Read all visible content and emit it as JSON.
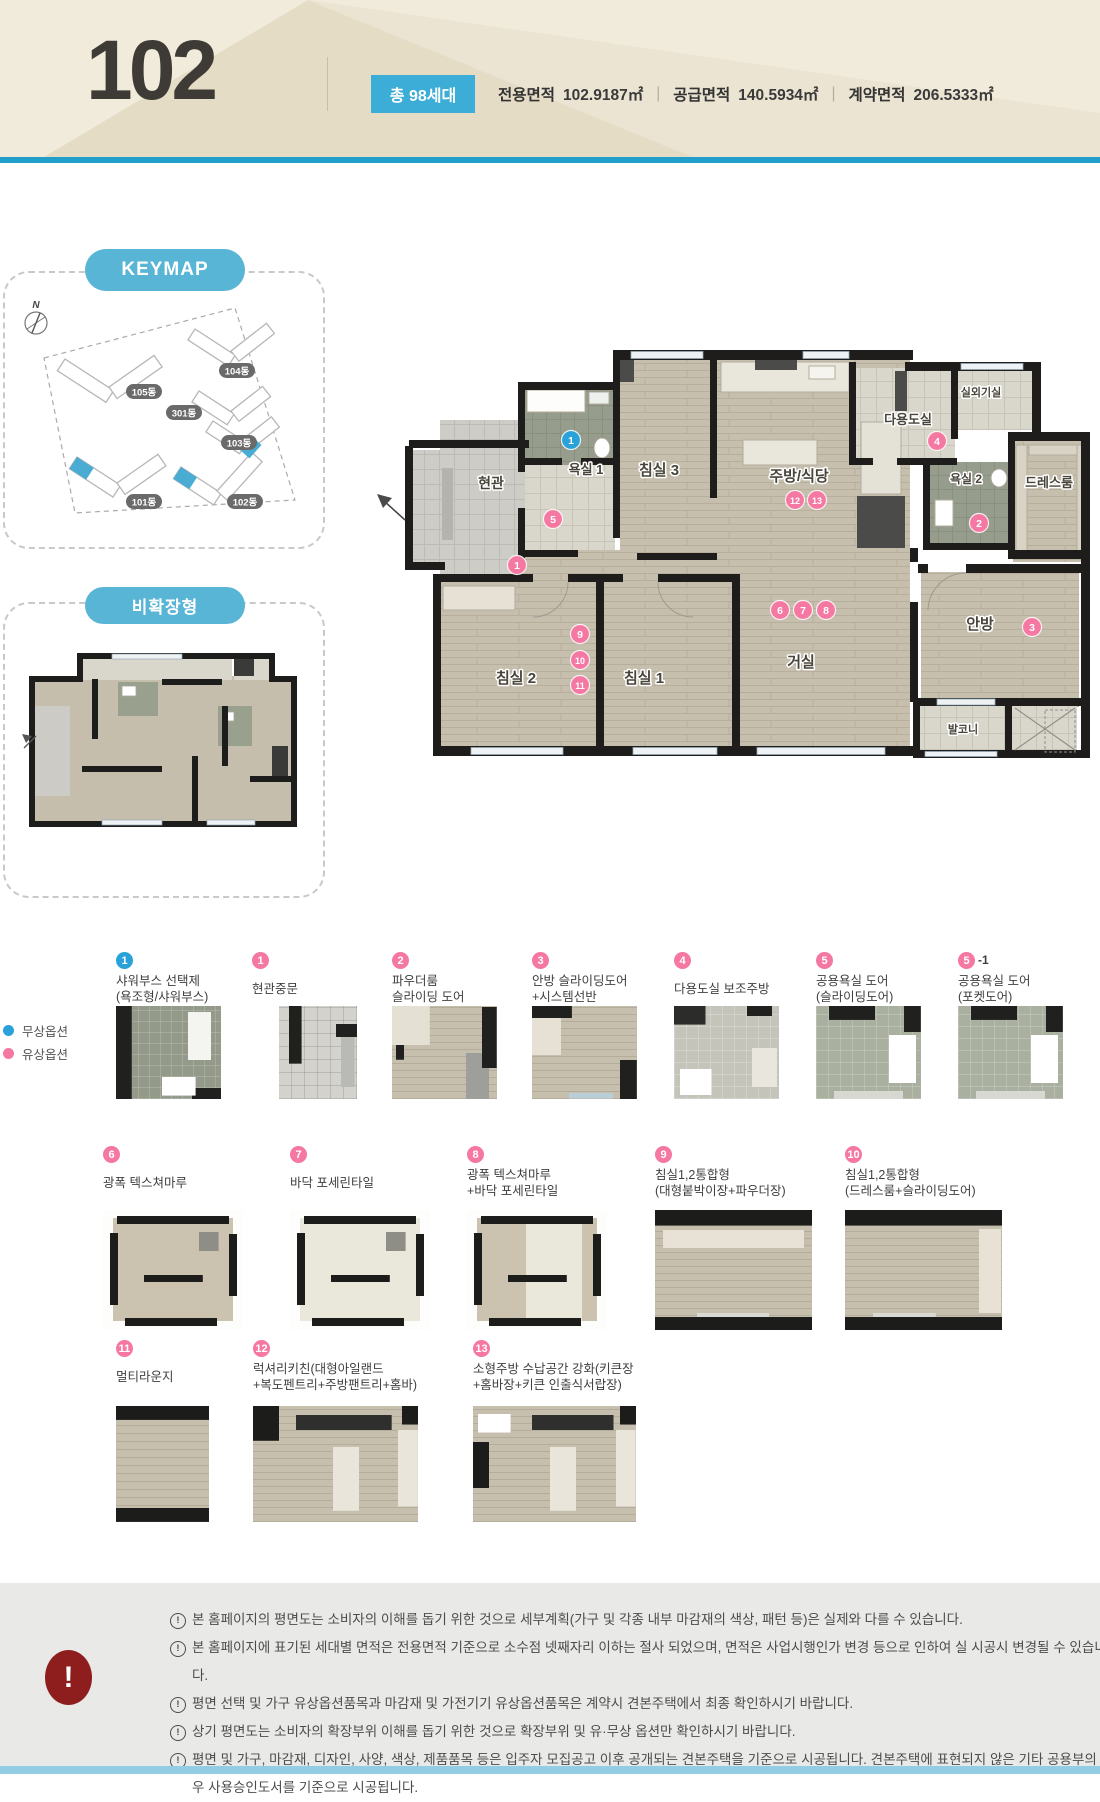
{
  "header": {
    "unit": "102",
    "badge": "총 98세대",
    "areas": [
      {
        "label": "전용면적",
        "value": "102.9187㎡"
      },
      {
        "label": "공급면적",
        "value": "140.5934㎡"
      },
      {
        "label": "계약면적",
        "value": "206.5333㎡"
      }
    ]
  },
  "keymap": {
    "title": "KEYMAP",
    "compass": "N",
    "buildings": [
      {
        "name": "105동",
        "x": 141,
        "y": 121
      },
      {
        "name": "104동",
        "x": 234,
        "y": 100
      },
      {
        "name": "301동",
        "x": 181,
        "y": 142
      },
      {
        "name": "103동",
        "x": 236,
        "y": 172
      },
      {
        "name": "101동",
        "x": 141,
        "y": 231
      },
      {
        "name": "102동",
        "x": 242,
        "y": 231
      }
    ]
  },
  "nonexpanded_title": "비확장형",
  "floorplan": {
    "rooms": [
      {
        "name": "현관",
        "x": 126,
        "y": 138,
        "s": 14
      },
      {
        "name": "욕실 1",
        "x": 221,
        "y": 124,
        "s": 13
      },
      {
        "name": "침실 3",
        "x": 294,
        "y": 125,
        "s": 15
      },
      {
        "name": "주방/식당",
        "x": 434,
        "y": 131,
        "s": 15
      },
      {
        "name": "다용도실",
        "x": 543,
        "y": 74,
        "s": 13
      },
      {
        "name": "실외기실",
        "x": 616,
        "y": 46,
        "s": 11
      },
      {
        "name": "욕실 2",
        "x": 601,
        "y": 133,
        "s": 12
      },
      {
        "name": "드레스룸",
        "x": 684,
        "y": 137,
        "s": 13
      },
      {
        "name": "안방",
        "x": 615,
        "y": 279,
        "s": 15
      },
      {
        "name": "거실",
        "x": 436,
        "y": 317,
        "s": 15
      },
      {
        "name": "침실 1",
        "x": 279,
        "y": 333,
        "s": 15
      },
      {
        "name": "침실 2",
        "x": 151,
        "y": 333,
        "s": 15
      },
      {
        "name": "발코니",
        "x": 598,
        "y": 383,
        "s": 11
      }
    ],
    "markers": [
      {
        "n": "1",
        "c": "blue",
        "x": 206,
        "y": 90
      },
      {
        "n": "5",
        "c": "pink",
        "x": 188,
        "y": 169
      },
      {
        "n": "1",
        "c": "pink",
        "x": 152,
        "y": 215
      },
      {
        "n": "12",
        "c": "pink",
        "x": 430,
        "y": 150
      },
      {
        "n": "13",
        "c": "pink",
        "x": 452,
        "y": 150
      },
      {
        "n": "4",
        "c": "pink",
        "x": 572,
        "y": 91
      },
      {
        "n": "2",
        "c": "pink",
        "x": 614,
        "y": 173
      },
      {
        "n": "3",
        "c": "pink",
        "x": 667,
        "y": 277
      },
      {
        "n": "6",
        "c": "pink",
        "x": 415,
        "y": 260
      },
      {
        "n": "7",
        "c": "pink",
        "x": 438,
        "y": 260
      },
      {
        "n": "8",
        "c": "pink",
        "x": 461,
        "y": 260
      },
      {
        "n": "9",
        "c": "pink",
        "x": 215,
        "y": 284
      },
      {
        "n": "10",
        "c": "pink",
        "x": 215,
        "y": 310
      },
      {
        "n": "11",
        "c": "pink",
        "x": 215,
        "y": 335
      }
    ]
  },
  "legend": {
    "free": "무상옵션",
    "paid": "유상옵션"
  },
  "colors": {
    "blue": "#29a2d9",
    "pink": "#f478a1",
    "teal": "#58b5d6"
  },
  "options": [
    {
      "num": "1",
      "color": "blue",
      "lines": [
        "샤워부스 선택제",
        "(욕조형/샤워부스)"
      ],
      "thumb": "bath-a",
      "thumb_name": "shower-booth-option-thumbnail"
    },
    {
      "num": "1",
      "color": "pink",
      "lines": [
        "현관중문"
      ],
      "thumb": "entry",
      "thumb_name": "entry-middle-door-option-thumbnail"
    },
    {
      "num": "2",
      "color": "pink",
      "lines": [
        "파우더룸",
        "슬라이딩 도어"
      ],
      "thumb": "powder",
      "thumb_name": "powder-room-sliding-door-option-thumbnail"
    },
    {
      "num": "3",
      "color": "pink",
      "lines": [
        "안방 슬라이딩도어",
        "+시스템선반"
      ],
      "thumb": "room-a",
      "thumb_name": "master-sliding-door-option-thumbnail"
    },
    {
      "num": "4",
      "color": "pink",
      "lines": [
        "다용도실 보조주방"
      ],
      "thumb": "utility",
      "thumb_name": "utility-sub-kitchen-option-thumbnail"
    },
    {
      "num": "5",
      "color": "pink",
      "lines": [
        "공용욕실 도어",
        "(슬라이딩도어)"
      ],
      "thumb": "bath-b",
      "thumb_name": "shared-bath-sliding-door-option-thumbnail"
    },
    {
      "num": "5",
      "suffix": "-1",
      "color": "pink",
      "lines": [
        "공용욕실 도어",
        "(포켓도어)"
      ],
      "thumb": "bath-b",
      "thumb_name": "shared-bath-pocket-door-option-thumbnail"
    },
    {
      "num": "6",
      "color": "pink",
      "lines": [
        "광폭 텍스쳐마루"
      ],
      "thumb": "plan-wood",
      "thumb_name": "wide-textured-floor-option-thumbnail"
    },
    {
      "num": "7",
      "color": "pink",
      "lines": [
        "바닥 포세린타일"
      ],
      "thumb": "plan-tile",
      "thumb_name": "porcelain-tile-floor-option-thumbnail"
    },
    {
      "num": "8",
      "color": "pink",
      "lines": [
        "광폭 텍스쳐마루",
        "+바닥 포세린타일"
      ],
      "thumb": "plan-mix",
      "thumb_name": "mixed-floor-option-thumbnail"
    },
    {
      "num": "9",
      "color": "pink",
      "lines": [
        "침실1,2통합형",
        "(대형붙박이장+파우더장)"
      ],
      "thumb": "wide-a",
      "thumb_name": "combined-bedroom-closet-option-thumbnail"
    },
    {
      "num": "10",
      "color": "pink",
      "lines": [
        "침실1,2통합형",
        "(드레스룸+슬라이딩도어)"
      ],
      "thumb": "wide-b",
      "thumb_name": "combined-bedroom-dressroom-option-thumbnail"
    },
    {
      "num": "11",
      "color": "pink",
      "lines": [
        "멀티라운지"
      ],
      "thumb": "lounge",
      "thumb_name": "multi-lounge-option-thumbnail"
    },
    {
      "num": "12",
      "color": "pink",
      "lines": [
        "럭셔리키친(대형아일랜드",
        "+복도펜트리+주방팬트리+홈바)"
      ],
      "thumb": "kitchen-a",
      "thumb_name": "luxury-kitchen-option-thumbnail"
    },
    {
      "num": "13",
      "color": "pink",
      "lines": [
        "소형주방 수납공간 강화(키큰장",
        "+홈바장+키큰 인출식서랍장)"
      ],
      "thumb": "kitchen-b",
      "thumb_name": "small-kitchen-storage-option-thumbnail"
    }
  ],
  "notices": {
    "icon": "!",
    "items": [
      "본 홈페이지의 평면도는 소비자의 이해를 돕기 위한 것으로 세부계획(가구 및 각종 내부 마감재의 색상, 패턴 등)은 실제와 다를 수 있습니다.",
      "본 홈페이지에 표기된 세대별 면적은 전용면적 기준으로 소수점 넷째자리 이하는 절사 되었으며, 면적은 사업시행인가 변경 등으로 인하여 실 시공시 변경될 수 있습니다.",
      "평면 선택 및 가구 유상옵션품목과 마감재 및 가전기기 유상옵션품목은 계약시 견본주택에서 최종 확인하시기 바랍니다.",
      "상기 평면도는 소비자의 확장부위 이해를 돕기 위한 것으로 확장부위 및 유·무상 옵션만 확인하시기 바랍니다.",
      "평면 및 가구, 마감재, 디자인, 사양, 색상, 제품품목 등은 입주자 모집공고 이후 공개되는 견본주택을 기준으로 시공됩니다. 견본주택에 표현되지 않은 기타 공용부의 경우 사용승인도서를 기준으로 시공됩니다."
    ]
  }
}
